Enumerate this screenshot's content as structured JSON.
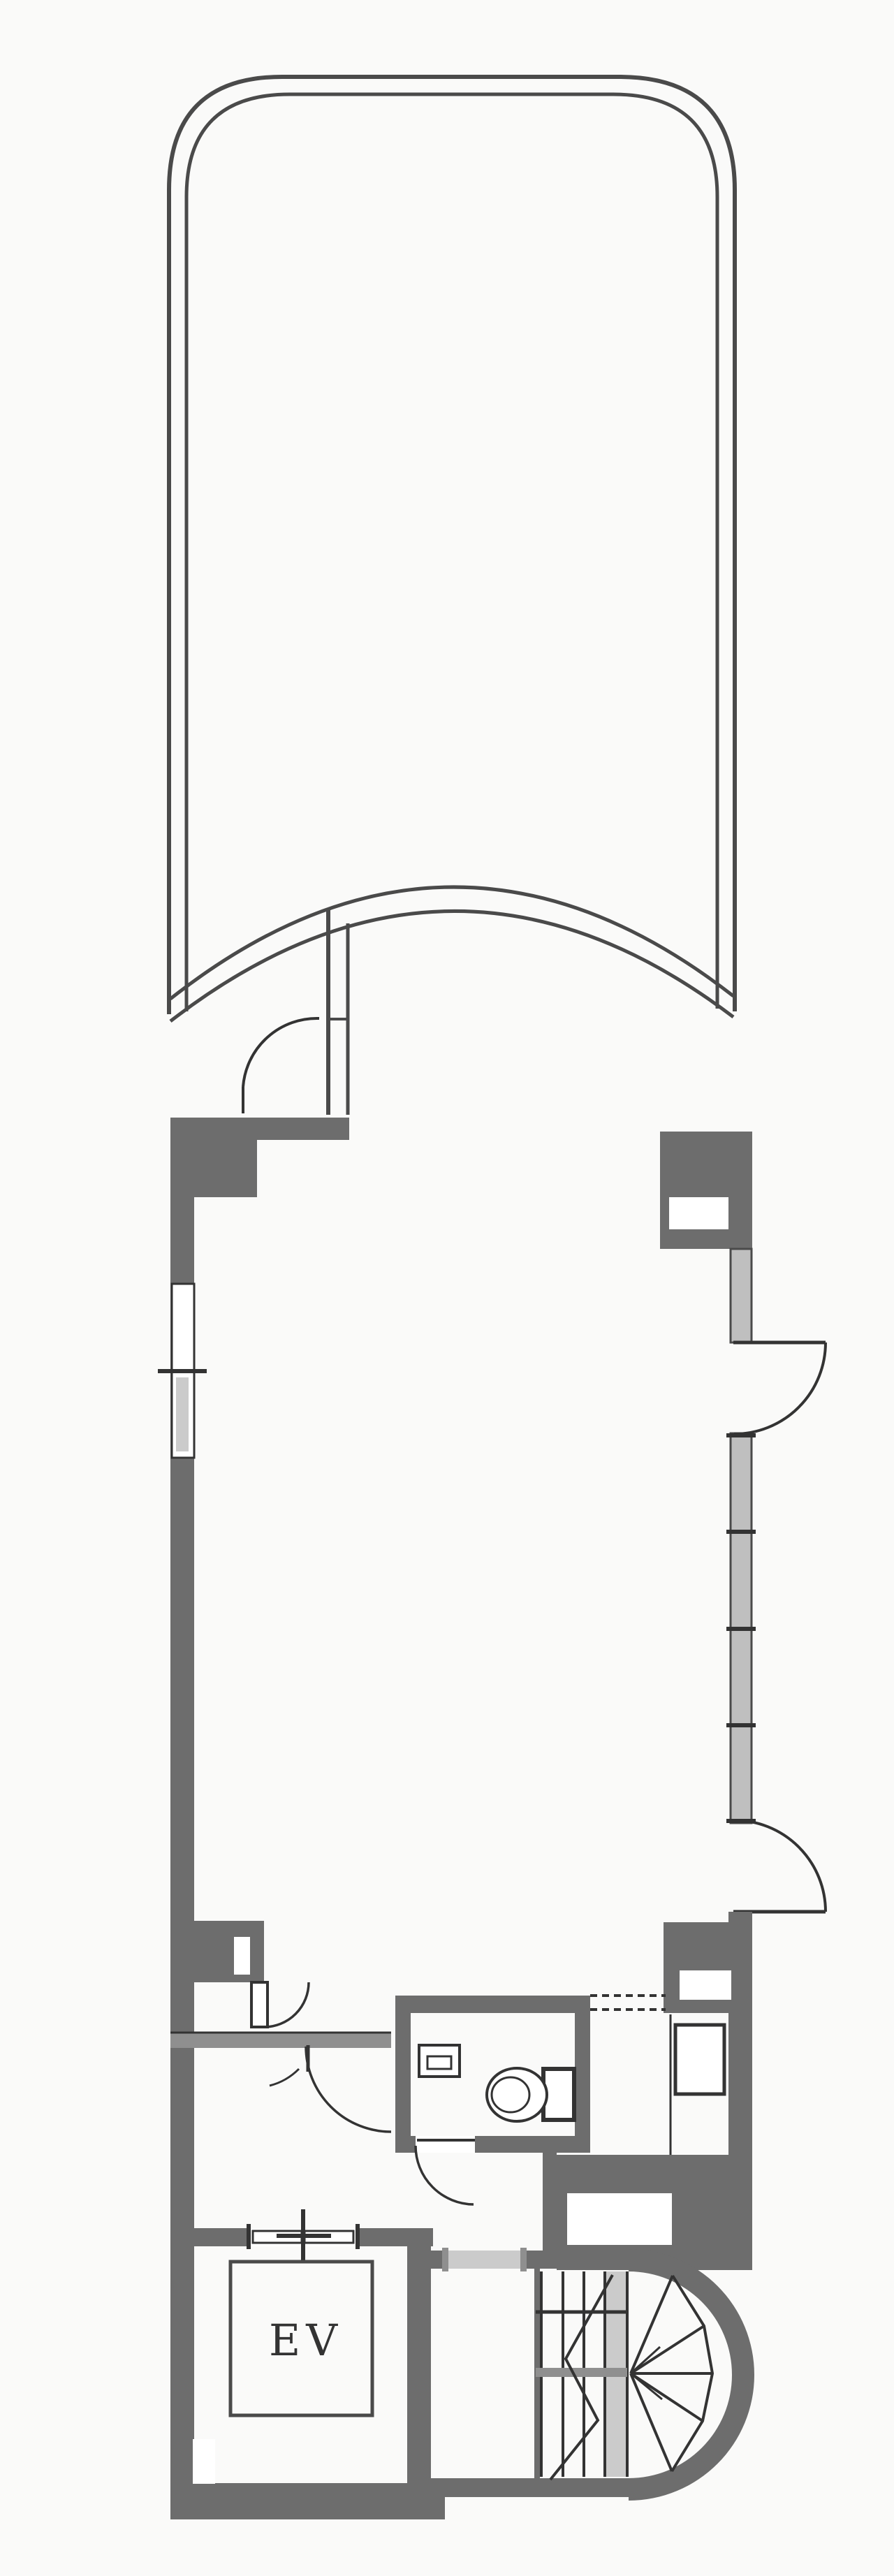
{
  "plan": {
    "label_ev": "EV",
    "colors": {
      "bg": "#fafaf9",
      "paper": "#ffffff",
      "wall": "#6d6d6d",
      "band": "#8f8f8f",
      "glaze": "#bfbfbf",
      "light": "#cbcbcb",
      "line": "#4a4a4a",
      "line_dark": "#333333"
    }
  }
}
